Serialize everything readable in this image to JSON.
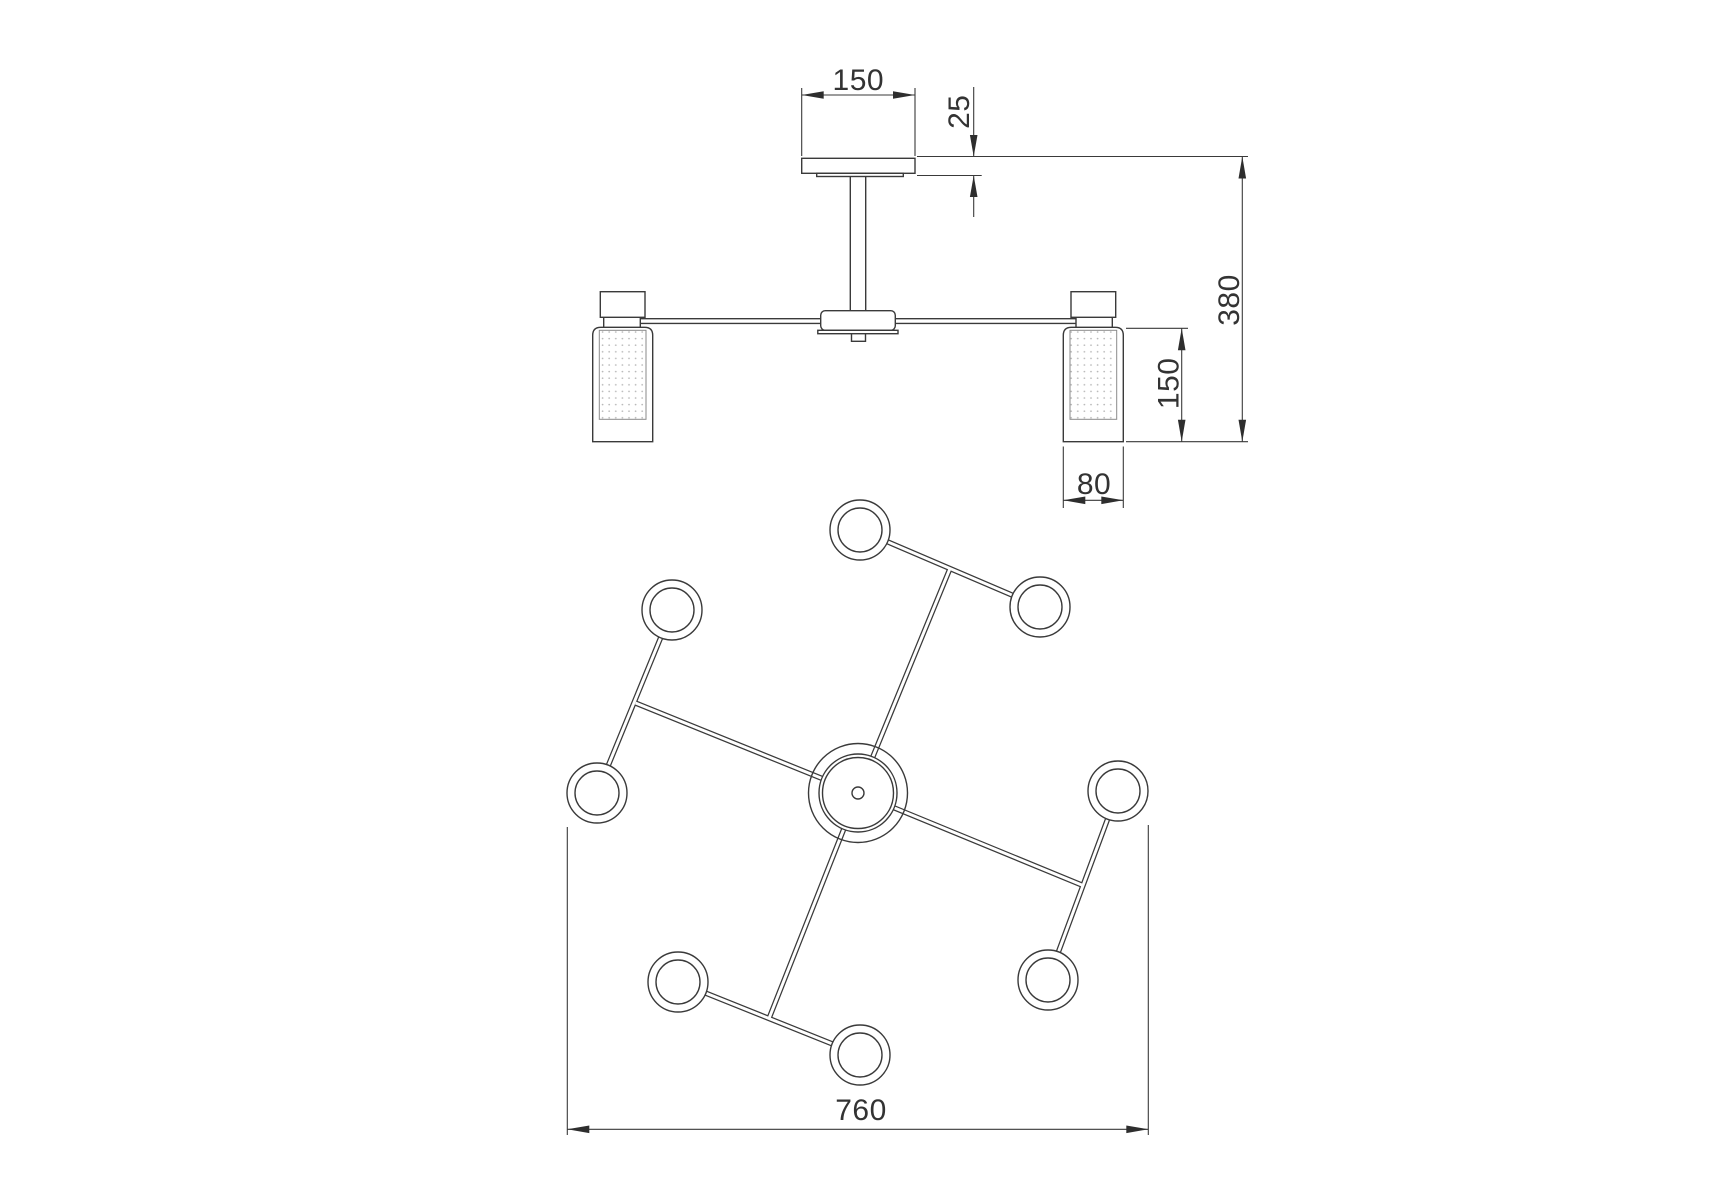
{
  "title": "Ceiling light fixture technical drawing",
  "colors": {
    "background": "#ffffff",
    "line": "#3a3a3a",
    "text": "#333333",
    "shade_dots": "#b8b8b8"
  },
  "views": {
    "elevation": "front-elevation-view",
    "plan": "top-plan-view"
  },
  "dimensions": {
    "canopy_width": "150",
    "canopy_thickness": "25",
    "fixture_height": "380",
    "shade_height": "150",
    "shade_width": "80",
    "overall_width": "760"
  }
}
